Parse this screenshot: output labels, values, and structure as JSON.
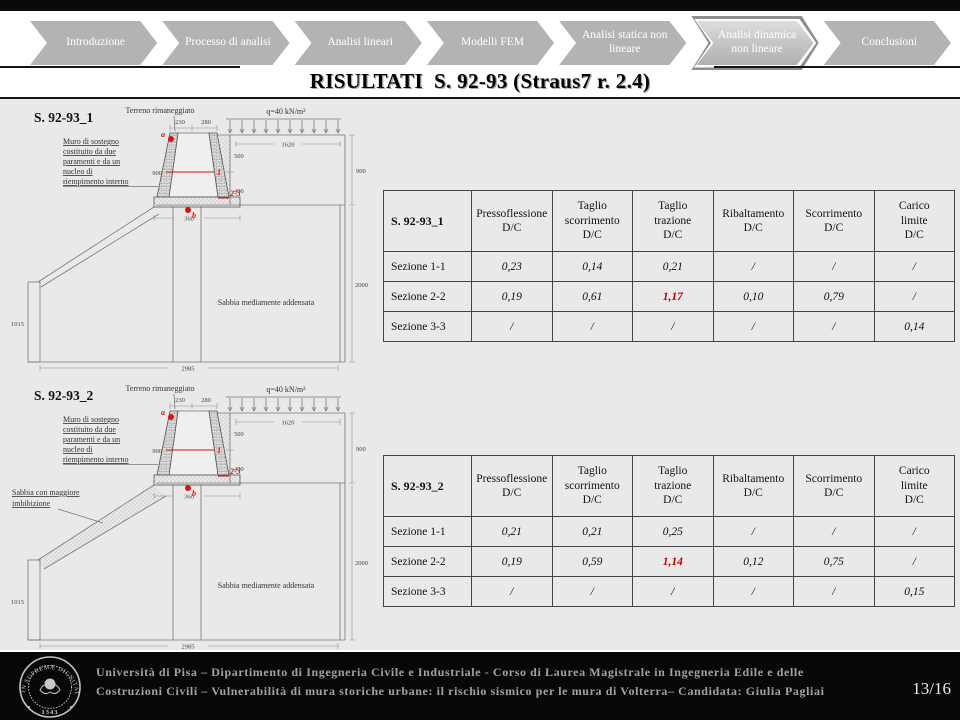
{
  "nav": {
    "items": [
      {
        "label": "Introduzione"
      },
      {
        "label": "Processo di analisi"
      },
      {
        "label": "Analisi lineari"
      },
      {
        "label": "Modelli FEM"
      },
      {
        "label": "Analisi statica non lineare"
      },
      {
        "label": "Analisi dinamica non lineare",
        "active": true
      },
      {
        "label": "Conclusioni"
      }
    ]
  },
  "title": "RISULTATI  S. 92-93 (Straus7 r. 2.4)",
  "figures": [
    {
      "label": "S. 92-93_1",
      "terrain_label": "Terreno rimaneggiato",
      "load_label": "q=40 kN/m²",
      "wall_note_lines": [
        "Muro di sostegno",
        "costituito da due",
        "paramenti e da un",
        "nucleo di",
        "riempimento interno"
      ],
      "soil_label": "Sabbia mediamente addensata",
      "marks": {
        "a": "a",
        "b": "b",
        "sec1": "1",
        "sec23": "2-3"
      },
      "dims": {
        "d230": "230",
        "d280": "280",
        "d1620": "1620",
        "d500": "500",
        "d400": "400",
        "d900_left": "900",
        "d900_right": "900",
        "d360": "360",
        "d1015": "1015",
        "d2000": "2000",
        "d2985": "2985"
      }
    },
    {
      "label": "S. 92-93_2",
      "terrain_label": "Terreno rimaneggiato",
      "load_label": "q=40 kN/m²",
      "wall_note_lines": [
        "Muro di sostegno",
        "costituito da due",
        "paramenti e da un",
        "nucleo di",
        "riempimento interno"
      ],
      "soil_label": "Sabbia mediamente addensata",
      "extra_soil_lines": [
        "Sabbia con maggiore",
        "imbibizione"
      ],
      "marks": {
        "a": "a",
        "b": "b",
        "sec1": "1",
        "sec23": "2-3"
      },
      "dims": {
        "d230": "230",
        "d280": "280",
        "d1620": "1620",
        "d500": "500",
        "d400": "400",
        "d900_left": "900",
        "d900_right": "900",
        "d360": "360",
        "d1015": "1015",
        "d2000": "2000",
        "d2985": "2985"
      }
    }
  ],
  "tables": [
    {
      "title": "S. 92-93_1",
      "headers": [
        "Pressoflessione\nD/C",
        "Taglio\nscorrimento\nD/C",
        "Taglio\ntrazione\nD/C",
        "Ribaltamento\nD/C",
        "Scorrimento\nD/C",
        "Carico\nlimite\nD/C"
      ],
      "rows": [
        {
          "label": "Sezione 1-1",
          "values": [
            "0,23",
            "0,14",
            "0,21",
            "/",
            "/",
            "/"
          ],
          "red": []
        },
        {
          "label": "Sezione 2-2",
          "values": [
            "0,19",
            "0,61",
            "1,17",
            "0,10",
            "0,79",
            "/"
          ],
          "red": [
            2
          ]
        },
        {
          "label": "Sezione 3-3",
          "values": [
            "/",
            "/",
            "/",
            "/",
            "/",
            "0,14"
          ],
          "red": []
        }
      ]
    },
    {
      "title": "S. 92-93_2",
      "headers": [
        "Pressoflessione\nD/C",
        "Taglio\nscorrimento\nD/C",
        "Taglio\ntrazione\nD/C",
        "Ribaltamento\nD/C",
        "Scorrimento\nD/C",
        "Carico\nlimite\nD/C"
      ],
      "rows": [
        {
          "label": "Sezione 1-1",
          "values": [
            "0,21",
            "0,21",
            "0,25",
            "/",
            "/",
            "/"
          ],
          "red": []
        },
        {
          "label": "Sezione 2-2",
          "values": [
            "0,19",
            "0,59",
            "1,14",
            "0,12",
            "0,75",
            "/"
          ],
          "red": [
            2
          ]
        },
        {
          "label": "Sezione 3-3",
          "values": [
            "/",
            "/",
            "/",
            "/",
            "/",
            "0,15"
          ],
          "red": []
        }
      ]
    }
  ],
  "footer": {
    "line1": "Università di Pisa – Dipartimento di Ingegneria Civile e Industriale - Corso di Laurea Magistrale in Ingegneria Edile e delle",
    "line2": "Costruzioni Civili – Vulnerabilità di mura storiche urbane: il rischio sismico per le mura di Volterra– Candidata: Giulia Pagliai",
    "page": "13/16",
    "logo": {
      "motto": "IN SUPREMÆ DIGNITATIS",
      "year": "1343"
    }
  },
  "colors": {
    "highlight_red": "#c00000",
    "chevron_gray": "#b3b3b3",
    "slide_bg": "#e9e9e9"
  }
}
